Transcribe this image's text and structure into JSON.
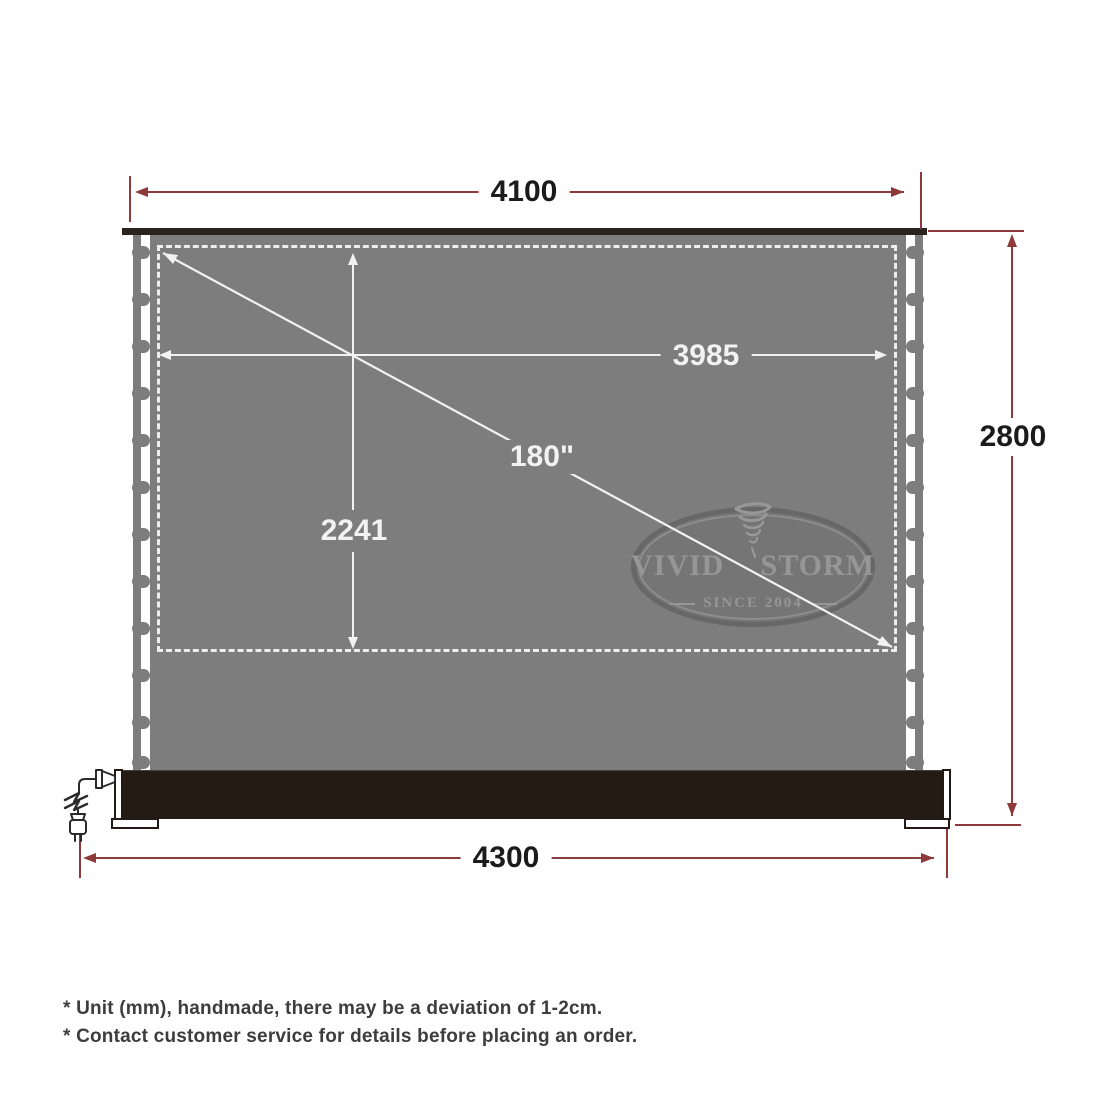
{
  "diagram": {
    "dim_top_width": "4100",
    "dim_viewable_width": "3985",
    "dim_viewable_height": "2241",
    "dim_diagonal": "180\"",
    "dim_total_height": "2800",
    "dim_base_width": "4300"
  },
  "logo": {
    "name_left": "VIVID",
    "name_right": "STORM",
    "since": "SINCE 2004"
  },
  "footnotes": [
    "* Unit (mm), handmade, there may be a deviation of 1-2cm.",
    "* Contact customer service for details before placing an order."
  ],
  "colors": {
    "dimension_red": "#8f3a3a",
    "screen_gray": "#7d7d7d",
    "housing_dark": "#251b15",
    "white_dimension": "#f2f2f2"
  }
}
